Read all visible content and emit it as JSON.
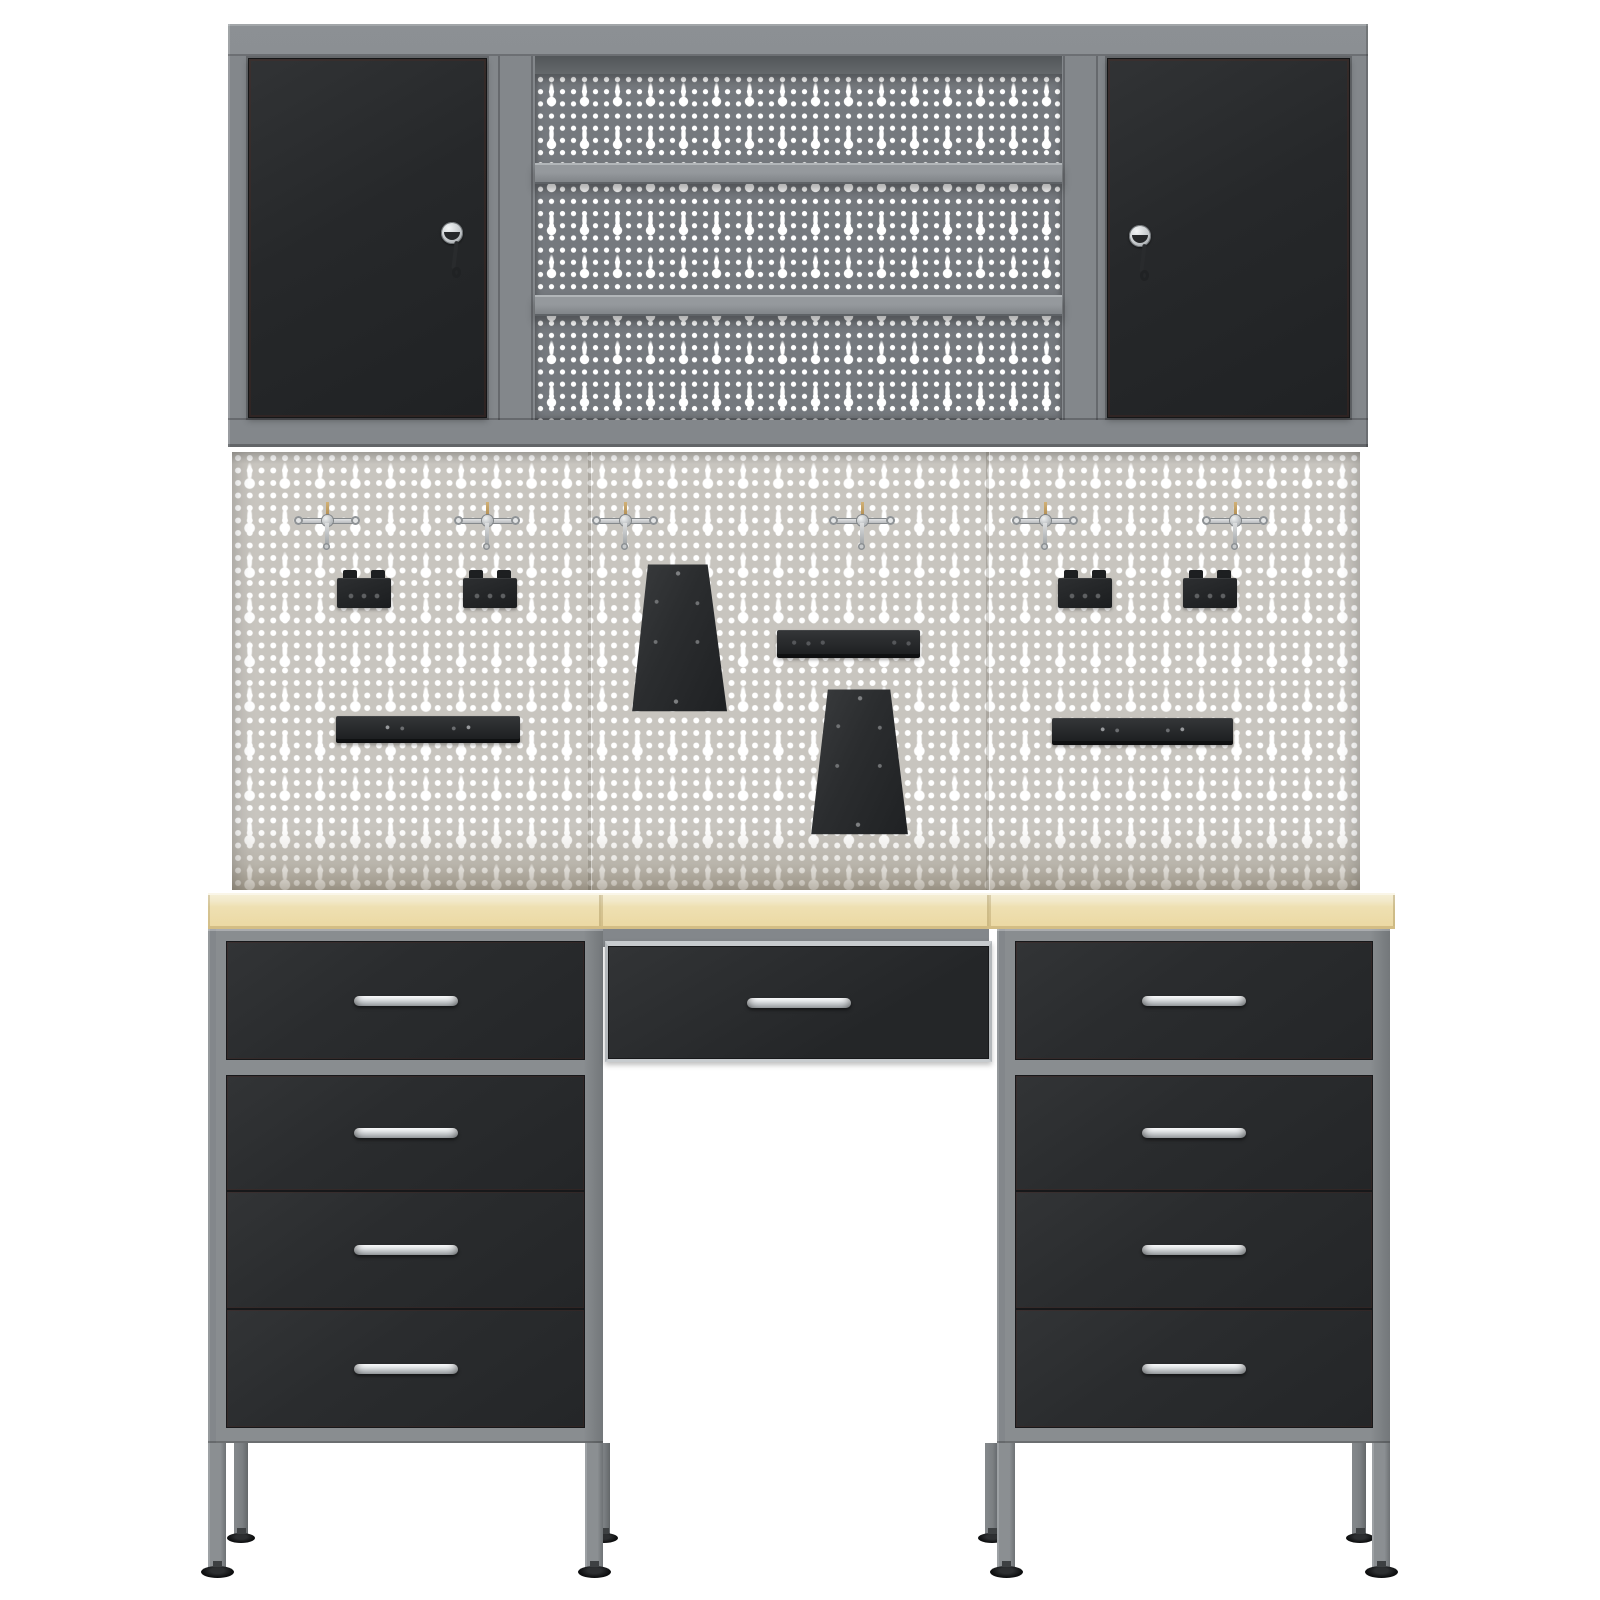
{
  "scene": {
    "description": "3D product render of a grey-and-black garage workbench storage system on a white background: two lockable wall cabinets flanking an open shelf unit with perforated back panel, a large light-grey euro-perforated pegboard with hooks and black tool holders, a beech-effect worktop and two 4-drawer pedestals with a wide centre drawer between them",
    "canvas": {
      "width": 1600,
      "height": 1600
    },
    "counts": {
      "wall_cabinet_doors": 2,
      "locks_with_keys": 2,
      "wall_shelves": 2,
      "pegboard_panels": 3,
      "pegboard_hooks": 6,
      "tool_brackets": 4,
      "tapered_tool_holders": 2,
      "tool_rails": 3,
      "worktop_segments": 3,
      "drawers_total": 9,
      "drawer_handles": 9,
      "legs": 8,
      "adjustable_feet": 8
    }
  },
  "colors": {
    "bg": "#ffffff",
    "frame": "#83878b",
    "frame_light": "#a4a8ab",
    "frame_dark": "#5f6367",
    "door": "#26282a",
    "drawer": "#2a2c2e",
    "pegboard_dark": "#75797e",
    "pegboard_light": "#c8c5bf",
    "hole": "#ffffff",
    "worktop_top": "#f6f0da",
    "worktop": "#eee0b2",
    "worktop_edge": "#d3bd85",
    "handle": "#b7bbbe",
    "hook_pin": "#d2b176",
    "accessory": "#222426",
    "foot": "#0e0f10"
  },
  "items": [
    {
      "n": "wall-unit-frame",
      "c": "wall-frame",
      "x": 228,
      "y": 24,
      "w": 1140,
      "h": 423
    },
    {
      "n": "wall-unit-top-edge-line",
      "c": "line-dark",
      "x": 228,
      "y": 54,
      "w": 1140,
      "h": 2
    },
    {
      "n": "shelf-unit-top-shadow",
      "c": "shelf-shadow",
      "x": 535,
      "y": 56,
      "w": 527,
      "h": 22
    },
    {
      "n": "shelf-unit-pegboard-back",
      "c": "pegboard-dark",
      "x": 535,
      "y": 74,
      "w": 527,
      "h": 346
    },
    {
      "n": "wall-shelf-upper",
      "c": "shelf",
      "x": 535,
      "y": 163,
      "w": 527,
      "h": 21
    },
    {
      "n": "wall-shelf-lower",
      "c": "shelf",
      "x": 535,
      "y": 295,
      "w": 527,
      "h": 21
    },
    {
      "n": "frame-pillar-seam-1",
      "c": "line-dark",
      "x": 498,
      "y": 56,
      "w": 2,
      "h": 364
    },
    {
      "n": "frame-pillar-seam-2",
      "c": "line-dark",
      "x": 531,
      "y": 56,
      "w": 2,
      "h": 364
    },
    {
      "n": "frame-pillar-seam-3",
      "c": "line-dark",
      "x": 1063,
      "y": 56,
      "w": 2,
      "h": 364
    },
    {
      "n": "frame-pillar-seam-4",
      "c": "line-dark",
      "x": 1096,
      "y": 56,
      "w": 2,
      "h": 364
    },
    {
      "n": "wall-unit-bottom-edge-line",
      "c": "line-dark",
      "x": 228,
      "y": 418,
      "w": 1140,
      "h": 2
    },
    {
      "n": "left-cabinet-door",
      "c": "door",
      "x": 248,
      "y": 58,
      "w": 239,
      "h": 360
    },
    {
      "n": "right-cabinet-door",
      "c": "door",
      "x": 1107,
      "y": 58,
      "w": 243,
      "h": 360
    },
    {
      "n": "left-door-lock-with-key",
      "c": "lock",
      "x": 441,
      "y": 222,
      "w": 22,
      "h": 58
    },
    {
      "n": "right-door-lock-with-key",
      "c": "lock",
      "x": 1129,
      "y": 225,
      "w": 22,
      "h": 58
    },
    {
      "n": "main-pegboard",
      "c": "pegboard-light",
      "x": 232,
      "y": 452,
      "w": 1128,
      "h": 438
    },
    {
      "n": "pegboard-panel-seam-1",
      "c": "peg-seam",
      "x": 588,
      "y": 452,
      "w": 3,
      "h": 438
    },
    {
      "n": "pegboard-panel-seam-2",
      "c": "peg-seam",
      "x": 986,
      "y": 452,
      "w": 3,
      "h": 438
    },
    {
      "n": "pegboard-hook-1",
      "c": "t-hook",
      "x": 296,
      "y": 502,
      "w": 62,
      "h": 50
    },
    {
      "n": "pegboard-hook-2",
      "c": "t-hook",
      "x": 456,
      "y": 502,
      "w": 62,
      "h": 50
    },
    {
      "n": "pegboard-hook-3",
      "c": "t-hook",
      "x": 594,
      "y": 502,
      "w": 62,
      "h": 50
    },
    {
      "n": "pegboard-hook-4",
      "c": "t-hook",
      "x": 831,
      "y": 502,
      "w": 62,
      "h": 50
    },
    {
      "n": "pegboard-hook-5",
      "c": "t-hook",
      "x": 1014,
      "y": 502,
      "w": 62,
      "h": 50
    },
    {
      "n": "pegboard-hook-6",
      "c": "t-hook",
      "x": 1204,
      "y": 502,
      "w": 62,
      "h": 50
    },
    {
      "n": "tool-bracket-1",
      "c": "bracket",
      "x": 337,
      "y": 570,
      "w": 54,
      "h": 38
    },
    {
      "n": "tool-bracket-2",
      "c": "bracket",
      "x": 463,
      "y": 570,
      "w": 54,
      "h": 38
    },
    {
      "n": "tool-bracket-3",
      "c": "bracket",
      "x": 1058,
      "y": 570,
      "w": 54,
      "h": 38
    },
    {
      "n": "tool-bracket-4",
      "c": "bracket",
      "x": 1183,
      "y": 570,
      "w": 54,
      "h": 38
    },
    {
      "n": "tapered-tool-holder-1",
      "c": "trap-a",
      "x": 625,
      "y": 563,
      "w": 102,
      "h": 149
    },
    {
      "n": "tool-rail-small",
      "c": "rail-s",
      "x": 777,
      "y": 630,
      "w": 143,
      "h": 28
    },
    {
      "n": "tapered-tool-holder-2",
      "c": "trap-b",
      "x": 806,
      "y": 688,
      "w": 104,
      "h": 147
    },
    {
      "n": "tool-rail-left",
      "c": "rail-l",
      "x": 336,
      "y": 716,
      "w": 184,
      "h": 27
    },
    {
      "n": "tool-rail-right",
      "c": "rail-l",
      "x": 1052,
      "y": 718,
      "w": 181,
      "h": 27
    },
    {
      "n": "center-drawer-support",
      "c": "gray-strip",
      "x": 601,
      "y": 929,
      "w": 388,
      "h": 18
    },
    {
      "n": "worktop-segment-left",
      "c": "worktop",
      "x": 208,
      "y": 893,
      "w": 393,
      "h": 36
    },
    {
      "n": "worktop-segment-center",
      "c": "worktop",
      "x": 601,
      "y": 893,
      "w": 388,
      "h": 36
    },
    {
      "n": "worktop-segment-right",
      "c": "worktop",
      "x": 989,
      "y": 893,
      "w": 406,
      "h": 36
    },
    {
      "n": "left-pedestal-back-left-leg",
      "c": "leg-back",
      "x": 234,
      "y": 1443,
      "w": 14,
      "h": 92
    },
    {
      "n": "left-pedestal-back-right-leg",
      "c": "leg-back",
      "x": 596,
      "y": 1443,
      "w": 14,
      "h": 92
    },
    {
      "n": "right-pedestal-back-left-leg",
      "c": "leg-back",
      "x": 985,
      "y": 1443,
      "w": 13,
      "h": 92
    },
    {
      "n": "right-pedestal-back-right-leg",
      "c": "leg-back",
      "x": 1352,
      "y": 1443,
      "w": 14,
      "h": 92
    },
    {
      "n": "left-pedestal-back-left-foot",
      "c": "foot-sm",
      "x": 227,
      "y": 1533,
      "w": 28,
      "h": 10
    },
    {
      "n": "left-pedestal-back-right-foot",
      "c": "foot-sm",
      "x": 590,
      "y": 1533,
      "w": 28,
      "h": 10
    },
    {
      "n": "right-pedestal-back-left-foot",
      "c": "foot-sm",
      "x": 978,
      "y": 1533,
      "w": 28,
      "h": 10
    },
    {
      "n": "right-pedestal-back-right-foot",
      "c": "foot-sm",
      "x": 1346,
      "y": 1533,
      "w": 28,
      "h": 10
    },
    {
      "n": "left-pedestal-front-left-leg",
      "c": "leg",
      "x": 208,
      "y": 1443,
      "w": 18,
      "h": 125
    },
    {
      "n": "left-pedestal-front-right-leg",
      "c": "leg",
      "x": 585,
      "y": 1443,
      "w": 18,
      "h": 125
    },
    {
      "n": "right-pedestal-front-left-leg",
      "c": "leg",
      "x": 997,
      "y": 1443,
      "w": 18,
      "h": 125
    },
    {
      "n": "right-pedestal-front-right-leg",
      "c": "leg",
      "x": 1372,
      "y": 1443,
      "w": 18,
      "h": 125
    },
    {
      "n": "left-pedestal-front-left-foot",
      "c": "foot",
      "x": 201,
      "y": 1566,
      "w": 33,
      "h": 12
    },
    {
      "n": "left-pedestal-front-right-foot",
      "c": "foot",
      "x": 578,
      "y": 1566,
      "w": 33,
      "h": 12
    },
    {
      "n": "right-pedestal-front-left-foot",
      "c": "foot",
      "x": 990,
      "y": 1566,
      "w": 33,
      "h": 12
    },
    {
      "n": "right-pedestal-front-right-foot",
      "c": "foot",
      "x": 1365,
      "y": 1566,
      "w": 33,
      "h": 12
    },
    {
      "n": "left-pedestal-frame",
      "c": "ped-frame",
      "x": 208,
      "y": 929,
      "w": 395,
      "h": 514
    },
    {
      "n": "right-pedestal-frame",
      "c": "ped-frame",
      "x": 997,
      "y": 929,
      "w": 393,
      "h": 514
    },
    {
      "n": "drawer-left-1",
      "c": "drawer",
      "x": 226,
      "y": 941,
      "w": 359,
      "h": 119
    },
    {
      "n": "drawer-left-2",
      "c": "drawer",
      "x": 226,
      "y": 1075,
      "w": 359,
      "h": 116
    },
    {
      "n": "drawer-left-3",
      "c": "drawer",
      "x": 226,
      "y": 1191,
      "w": 359,
      "h": 118
    },
    {
      "n": "drawer-left-4",
      "c": "drawer",
      "x": 226,
      "y": 1309,
      "w": 359,
      "h": 119
    },
    {
      "n": "drawer-right-1",
      "c": "drawer",
      "x": 1015,
      "y": 941,
      "w": 358,
      "h": 119
    },
    {
      "n": "drawer-right-2",
      "c": "drawer",
      "x": 1015,
      "y": 1075,
      "w": 358,
      "h": 116
    },
    {
      "n": "drawer-right-3",
      "c": "drawer",
      "x": 1015,
      "y": 1191,
      "w": 358,
      "h": 118
    },
    {
      "n": "drawer-right-4",
      "c": "drawer",
      "x": 1015,
      "y": 1309,
      "w": 358,
      "h": 119
    },
    {
      "n": "center-drawer",
      "c": "center-drawer",
      "x": 605,
      "y": 941,
      "w": 387,
      "h": 121
    }
  ]
}
